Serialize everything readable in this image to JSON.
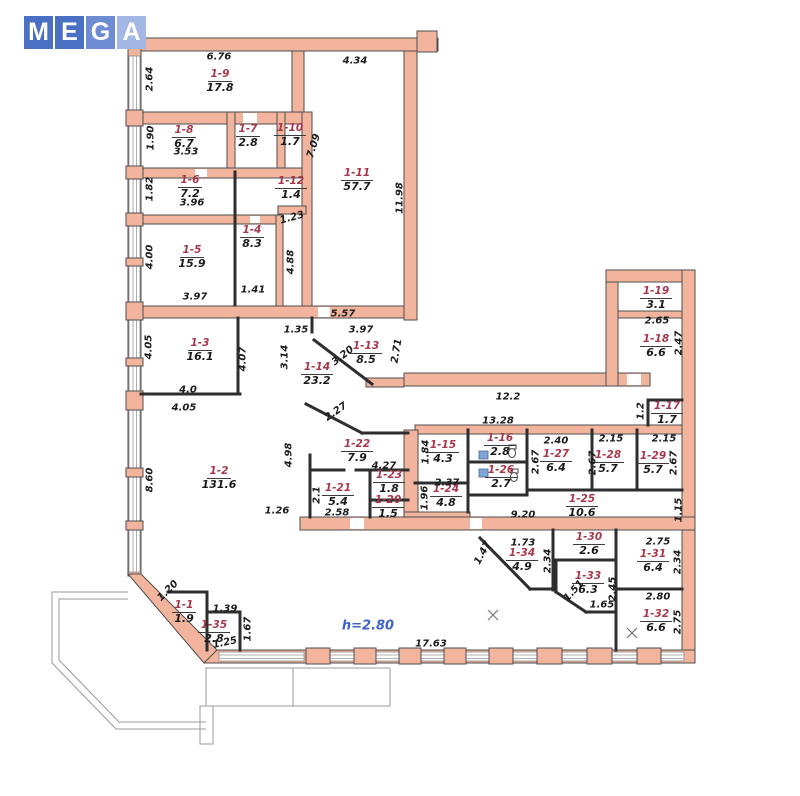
{
  "watermark": {
    "squares": [
      {
        "letter": "M",
        "color": "#4a70c4"
      },
      {
        "letter": "E",
        "color": "#4a70c4"
      },
      {
        "letter": "G",
        "color": "#6d8cd4"
      },
      {
        "letter": "A",
        "color": "#a3b7e4"
      }
    ]
  },
  "colors": {
    "wall_fill": "#f2b49d",
    "wall_stroke": "#4e4e50",
    "partition": "#2e2e30",
    "room_id": "#a8374b",
    "text": "#1b1b1b",
    "height_note": "#3b63c8",
    "balcony": "#9a9a9a",
    "window_blue": "#7ea7d8"
  },
  "plan": {
    "height_note": "h=2.80",
    "rooms": [
      {
        "id": "1-1",
        "area": "1.9",
        "x": 184,
        "y": 613
      },
      {
        "id": "1-2",
        "area": "131.6",
        "x": 219,
        "y": 479
      },
      {
        "id": "1-3",
        "area": "16.1",
        "x": 200,
        "y": 351
      },
      {
        "id": "1-4",
        "area": "8.3",
        "x": 252,
        "y": 238
      },
      {
        "id": "1-5",
        "area": "15.9",
        "x": 192,
        "y": 258
      },
      {
        "id": "1-6",
        "area": "7.2",
        "x": 190,
        "y": 188
      },
      {
        "id": "1-7",
        "area": "2.8",
        "x": 248,
        "y": 137
      },
      {
        "id": "1-8",
        "area": "6.7",
        "x": 184,
        "y": 138
      },
      {
        "id": "1-9",
        "area": "17.8",
        "x": 220,
        "y": 82
      },
      {
        "id": "1-10",
        "area": "1.7",
        "x": 290,
        "y": 136
      },
      {
        "id": "1-11",
        "area": "57.7",
        "x": 357,
        "y": 181
      },
      {
        "id": "1-12",
        "area": "1.4",
        "x": 291,
        "y": 189
      },
      {
        "id": "1-13",
        "area": "8.5",
        "x": 366,
        "y": 354
      },
      {
        "id": "1-14",
        "area": "23.2",
        "x": 317,
        "y": 375
      },
      {
        "id": "1-15",
        "area": "4.3",
        "x": 443,
        "y": 453
      },
      {
        "id": "1-16",
        "area": "2.8",
        "x": 500,
        "y": 446
      },
      {
        "id": "1-17",
        "area": "1.7",
        "x": 667,
        "y": 414
      },
      {
        "id": "1-18",
        "area": "6.6",
        "x": 656,
        "y": 347
      },
      {
        "id": "1-19",
        "area": "3.1",
        "x": 656,
        "y": 299
      },
      {
        "id": "1-20",
        "area": "1.5",
        "x": 388,
        "y": 508
      },
      {
        "id": "1-21",
        "area": "5.4",
        "x": 338,
        "y": 496
      },
      {
        "id": "1-22",
        "area": "7.9",
        "x": 357,
        "y": 452
      },
      {
        "id": "1-23",
        "area": "1.8",
        "x": 389,
        "y": 483
      },
      {
        "id": "1-24",
        "area": "4.8",
        "x": 446,
        "y": 497
      },
      {
        "id": "1-25",
        "area": "10.6",
        "x": 582,
        "y": 507
      },
      {
        "id": "1-26",
        "area": "2.7",
        "x": 501,
        "y": 478
      },
      {
        "id": "1-27",
        "area": "6.4",
        "x": 556,
        "y": 462
      },
      {
        "id": "1-28",
        "area": "5.7",
        "x": 608,
        "y": 463
      },
      {
        "id": "1-29",
        "area": "5.7",
        "x": 653,
        "y": 464
      },
      {
        "id": "1-30",
        "area": "2.6",
        "x": 589,
        "y": 545
      },
      {
        "id": "1-31",
        "area": "6.4",
        "x": 653,
        "y": 562
      },
      {
        "id": "1-32",
        "area": "6.6",
        "x": 656,
        "y": 622
      },
      {
        "id": "1-33",
        "area": "6.3",
        "x": 588,
        "y": 584
      },
      {
        "id": "1-34",
        "area": "4.9",
        "x": 522,
        "y": 561
      },
      {
        "id": "1-35",
        "area": "2.8",
        "x": 214,
        "y": 633
      }
    ],
    "dims": [
      {
        "t": "2.64",
        "x": 150,
        "y": 79,
        "r": -90
      },
      {
        "t": "6.76",
        "x": 219,
        "y": 57,
        "r": 0
      },
      {
        "t": "4.34",
        "x": 355,
        "y": 61,
        "r": 0
      },
      {
        "t": "1.90",
        "x": 151,
        "y": 138,
        "r": -90
      },
      {
        "t": "3.53",
        "x": 186,
        "y": 152,
        "r": 0
      },
      {
        "t": "7.09",
        "x": 314,
        "y": 146,
        "r": -72
      },
      {
        "t": "11.98",
        "x": 400,
        "y": 198,
        "r": -90
      },
      {
        "t": "1.82",
        "x": 150,
        "y": 189,
        "r": -90
      },
      {
        "t": "3.96",
        "x": 192,
        "y": 203,
        "r": 0
      },
      {
        "t": "1.23",
        "x": 292,
        "y": 218,
        "r": -15
      },
      {
        "t": "4.88",
        "x": 291,
        "y": 262,
        "r": -90
      },
      {
        "t": "4.00",
        "x": 150,
        "y": 257,
        "r": -90
      },
      {
        "t": "1.41",
        "x": 253,
        "y": 290,
        "r": 0
      },
      {
        "t": "3.97",
        "x": 195,
        "y": 297,
        "r": 0
      },
      {
        "t": "4.05",
        "x": 149,
        "y": 347,
        "r": -90
      },
      {
        "t": "4.07",
        "x": 243,
        "y": 359,
        "r": -90
      },
      {
        "t": "4.0",
        "x": 188,
        "y": 390,
        "r": 0
      },
      {
        "t": "4.05",
        "x": 184,
        "y": 408,
        "r": 0
      },
      {
        "t": "1.35",
        "x": 296,
        "y": 330,
        "r": 0
      },
      {
        "t": "5.57",
        "x": 343,
        "y": 314,
        "r": 0
      },
      {
        "t": "3.97",
        "x": 361,
        "y": 330,
        "r": 0
      },
      {
        "t": "3.14",
        "x": 285,
        "y": 357,
        "r": -90
      },
      {
        "t": "3.20",
        "x": 343,
        "y": 356,
        "r": -38
      },
      {
        "t": "2.71",
        "x": 397,
        "y": 351,
        "r": -80
      },
      {
        "t": "2.27",
        "x": 336,
        "y": 412,
        "r": -35
      },
      {
        "t": "12.2",
        "x": 508,
        "y": 397,
        "r": 0
      },
      {
        "t": "13.28",
        "x": 498,
        "y": 421,
        "r": 0
      },
      {
        "t": "1.2",
        "x": 641,
        "y": 411,
        "r": -90
      },
      {
        "t": "8.60",
        "x": 150,
        "y": 480,
        "r": -90
      },
      {
        "t": "4.98",
        "x": 289,
        "y": 455,
        "r": -90
      },
      {
        "t": "1.26",
        "x": 277,
        "y": 511,
        "r": 0
      },
      {
        "t": "4.27",
        "x": 384,
        "y": 466,
        "r": 0
      },
      {
        "t": "2.1",
        "x": 317,
        "y": 495,
        "r": -90
      },
      {
        "t": "2.58",
        "x": 337,
        "y": 513,
        "r": 0
      },
      {
        "t": "1.84",
        "x": 426,
        "y": 452,
        "r": -90
      },
      {
        "t": "2.37",
        "x": 447,
        "y": 483,
        "r": 0
      },
      {
        "t": "1.96",
        "x": 425,
        "y": 498,
        "r": -90
      },
      {
        "t": "2.40",
        "x": 556,
        "y": 441,
        "r": 0
      },
      {
        "t": "2.67",
        "x": 536,
        "y": 462,
        "r": -90
      },
      {
        "t": "2.67",
        "x": 593,
        "y": 463,
        "r": -90
      },
      {
        "t": "2.15",
        "x": 611,
        "y": 439,
        "r": 0
      },
      {
        "t": "2.15",
        "x": 664,
        "y": 439,
        "r": 0
      },
      {
        "t": "2.67",
        "x": 674,
        "y": 463,
        "r": -90
      },
      {
        "t": "9.20",
        "x": 523,
        "y": 515,
        "r": 0
      },
      {
        "t": "1.15",
        "x": 679,
        "y": 510,
        "r": -90
      },
      {
        "t": "2.65",
        "x": 657,
        "y": 321,
        "r": 0
      },
      {
        "t": "2.47",
        "x": 679,
        "y": 343,
        "r": -90
      },
      {
        "t": "1.73",
        "x": 523,
        "y": 543,
        "r": 0
      },
      {
        "t": "1.47",
        "x": 483,
        "y": 553,
        "r": -62
      },
      {
        "t": "2.34",
        "x": 548,
        "y": 561,
        "r": -90
      },
      {
        "t": "2.75",
        "x": 658,
        "y": 542,
        "r": 0
      },
      {
        "t": "2.34",
        "x": 678,
        "y": 562,
        "r": -90
      },
      {
        "t": "2.80",
        "x": 658,
        "y": 597,
        "r": 0
      },
      {
        "t": "2.75",
        "x": 678,
        "y": 622,
        "r": -90
      },
      {
        "t": "2.45",
        "x": 613,
        "y": 589,
        "r": -90
      },
      {
        "t": "1.51",
        "x": 574,
        "y": 591,
        "r": -48
      },
      {
        "t": "1.65",
        "x": 602,
        "y": 605,
        "r": 0
      },
      {
        "t": "1.20",
        "x": 168,
        "y": 591,
        "r": -45
      },
      {
        "t": "1.39",
        "x": 225,
        "y": 609,
        "r": 0
      },
      {
        "t": "1.67",
        "x": 248,
        "y": 629,
        "r": -90
      },
      {
        "t": "1.25",
        "x": 225,
        "y": 643,
        "r": -12
      },
      {
        "t": "17.63",
        "x": 431,
        "y": 644,
        "r": 0
      }
    ]
  }
}
